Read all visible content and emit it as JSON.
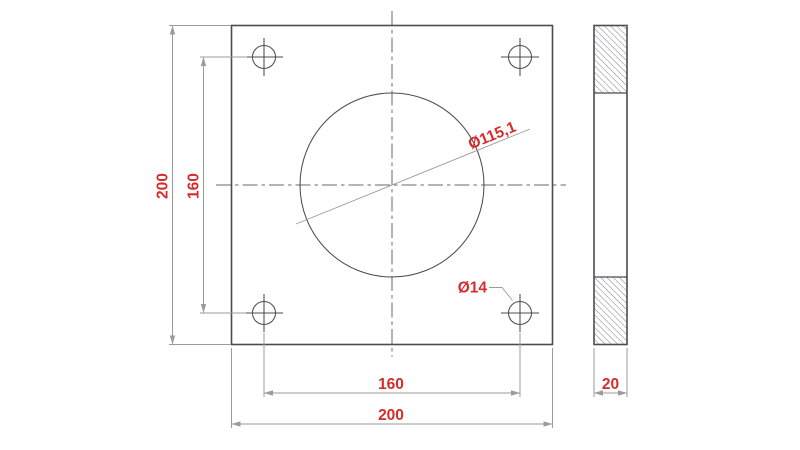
{
  "drawing": {
    "type": "technical-drawing-flange-plate",
    "views": {
      "front": "square plate with center bore and four corner bolt holes",
      "side": "section view with hatched material above and below the bore"
    },
    "dimensions": {
      "plate_width": "200",
      "plate_height": "200",
      "hole_spacing_horizontal": "160",
      "hole_spacing_vertical": "160",
      "center_hole_diameter": "Ø115,1",
      "corner_hole_diameter": "Ø14",
      "thickness": "20"
    },
    "colors": {
      "dimension_text": "#d62b2b",
      "outline": "#4c4c50",
      "dimension_lines": "#9b9b9b",
      "centerlines": "#68686c",
      "hatch_lines": "#74747a",
      "background": "#ffffff"
    }
  }
}
